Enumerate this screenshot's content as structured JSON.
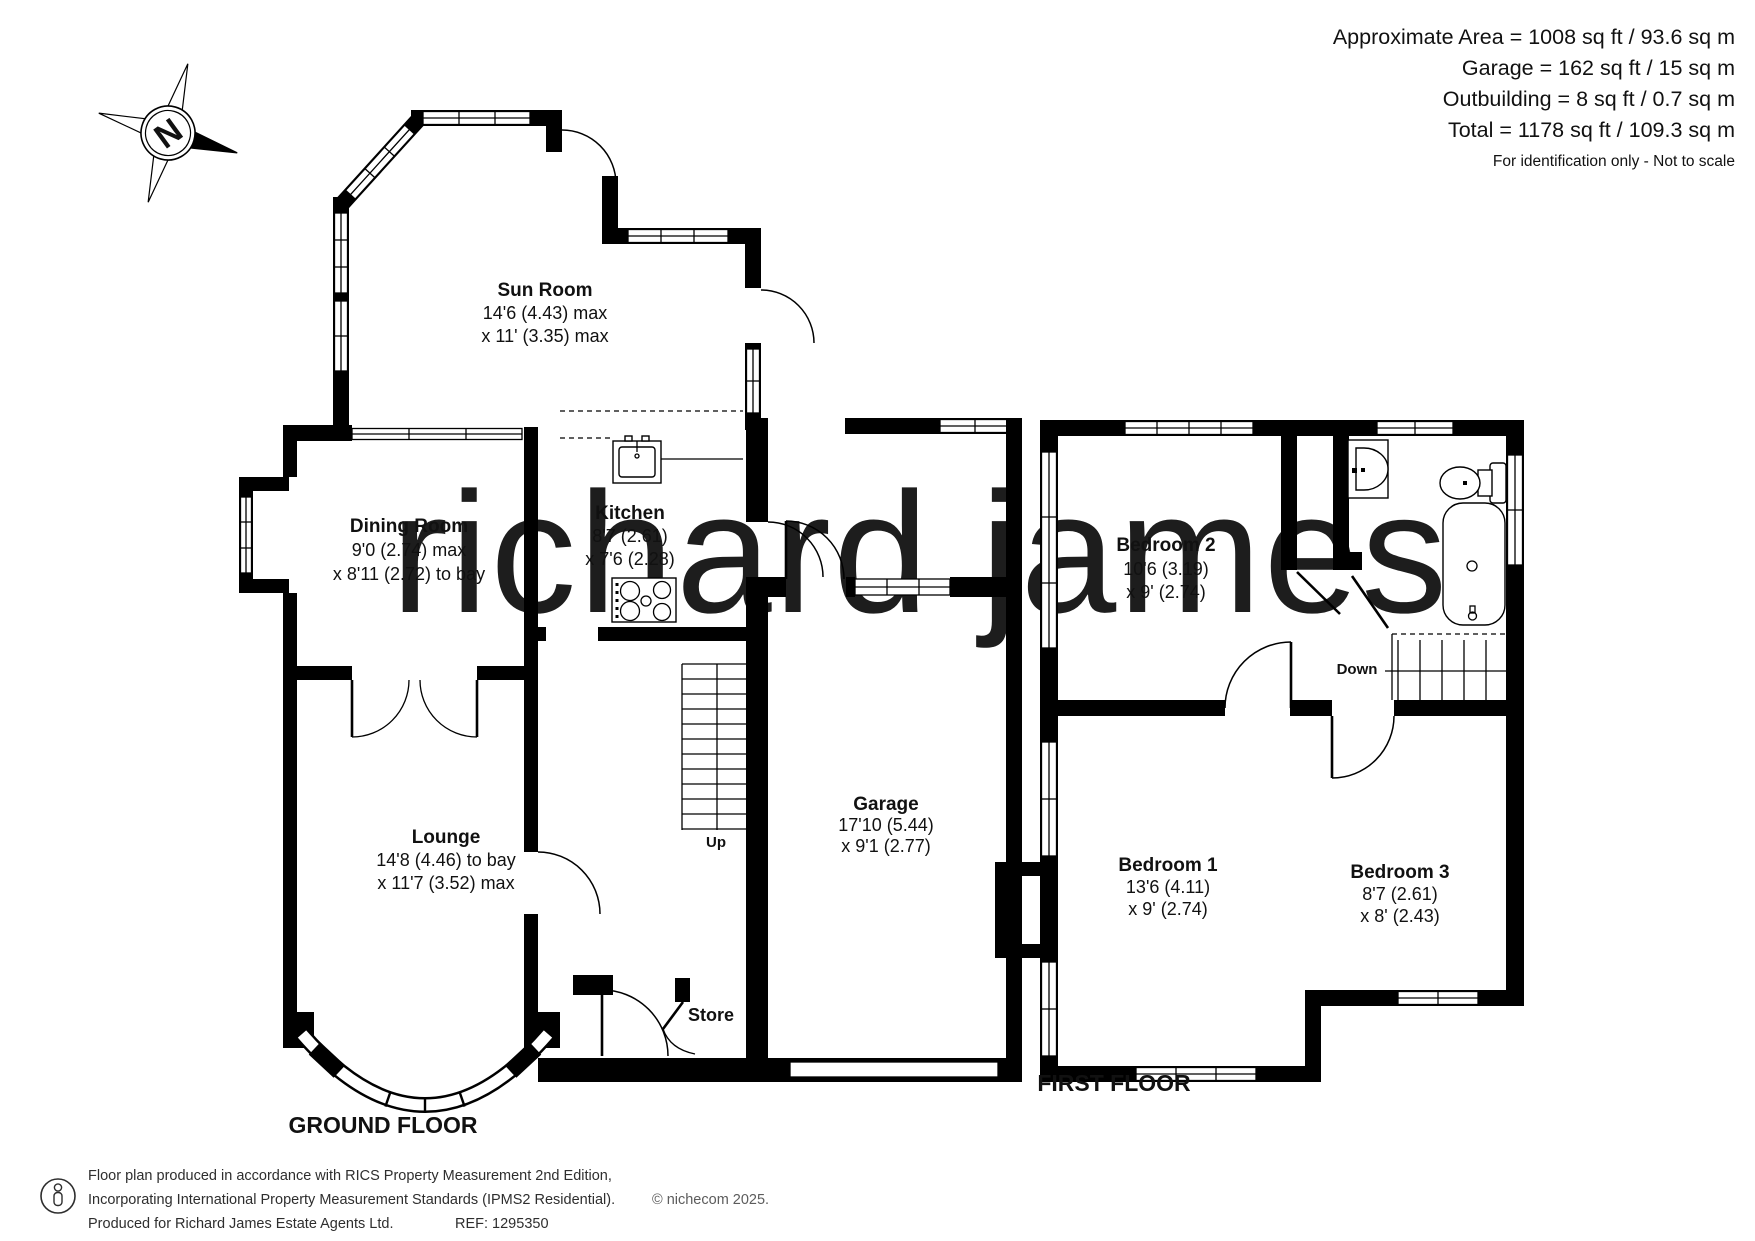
{
  "header": {
    "line1": "Approximate Area = 1008 sq ft / 93.6 sq m",
    "line2": "Garage = 162 sq ft / 15 sq m",
    "line3": "Outbuilding = 8 sq ft / 0.7 sq m",
    "line4": "Total = 1178 sq ft / 109.3 sq m",
    "note": "For identification only - Not to scale"
  },
  "compass": {
    "north_label": "N"
  },
  "watermark": {
    "text": "richard james",
    "color": "#f1ddb8"
  },
  "ground_floor": {
    "title": "GROUND FLOOR",
    "sun_room": {
      "name": "Sun Room",
      "dim1": "14'6 (4.43) max",
      "dim2": "x 11' (3.35) max"
    },
    "dining_room": {
      "name": "Dining Room",
      "dim1": "9'0 (2.74) max",
      "dim2": "x 8'11 (2.72) to bay"
    },
    "kitchen": {
      "name": "Kitchen",
      "dim1": "8'7 (2.61)",
      "dim2": "x 7'6 (2.28)"
    },
    "lounge": {
      "name": "Lounge",
      "dim1": "14'8 (4.46) to bay",
      "dim2": "x 11'7 (3.52) max"
    },
    "garage": {
      "name": "Garage",
      "dim1": "17'10 (5.44)",
      "dim2": "x 9'1 (2.77)"
    },
    "store_label": "Store",
    "up_label": "Up"
  },
  "first_floor": {
    "title": "FIRST FLOOR",
    "bedroom1": {
      "name": "Bedroom 1",
      "dim1": "13'6 (4.11)",
      "dim2": "x 9' (2.74)"
    },
    "bedroom2": {
      "name": "Bedroom 2",
      "dim1": "10'6 (3.19)",
      "dim2": "x 9' (2.74)"
    },
    "bedroom3": {
      "name": "Bedroom 3",
      "dim1": "8'7 (2.61)",
      "dim2": "x 8' (2.43)"
    },
    "down_label": "Down"
  },
  "footer": {
    "line1": "Floor plan produced in accordance with RICS Property Measurement 2nd Edition,",
    "line2": "Incorporating International Property Measurement Standards (IPMS2 Residential).",
    "copyright": "© nichecom 2025.",
    "line3": "Produced for Richard James Estate Agents Ltd.",
    "ref": "REF: 1295350"
  }
}
